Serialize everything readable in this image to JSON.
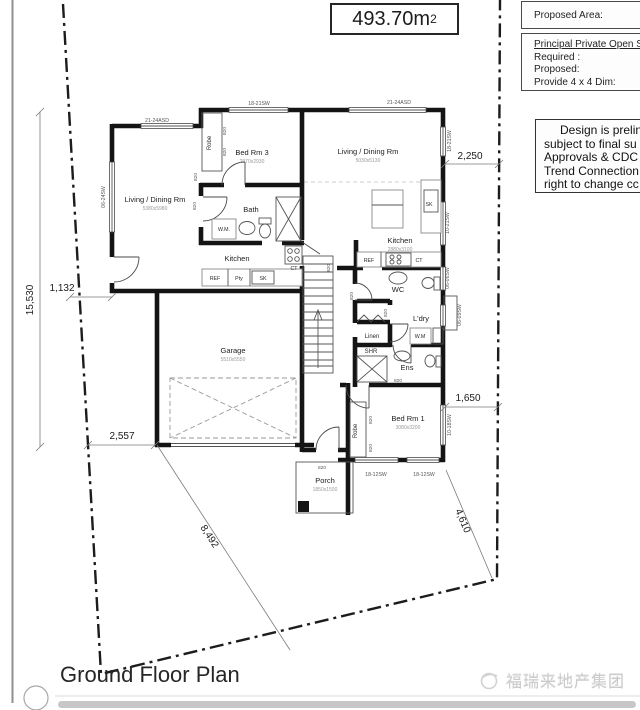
{
  "header": {
    "area": "493.70m",
    "area_sup": "2"
  },
  "side": {
    "proposed_area_label": "Proposed Area:",
    "pos_title": "Principal Private Open Spa",
    "pos_required": "Required :",
    "pos_proposed": "Proposed:",
    "pos_provide": "Provide 4 x 4 Dim:",
    "note_line1": "Design is prelin",
    "note_line2": "subject to final su",
    "note_line3": "Approvals & CDC",
    "note_line4": "Trend Connection",
    "note_line5": "right to change cc"
  },
  "plan": {
    "rooms": {
      "living_left": {
        "name": "Living / Dining Rm",
        "size": "5380x5980"
      },
      "bed3": {
        "name": "Bed Rm 3",
        "size": "2970x2930"
      },
      "bath": {
        "name": "Bath"
      },
      "kitchen_left": {
        "name": "Kitchen"
      },
      "living_right": {
        "name": "Living / Dining Rm",
        "size": "5030x5130"
      },
      "kitchen_right": {
        "name": "Kitchen",
        "size": "2880x3100"
      },
      "wc": {
        "name": "WC"
      },
      "ldry": {
        "name": "L'dry"
      },
      "linen": {
        "name": "Linen"
      },
      "shr": {
        "name": "SHR"
      },
      "ens": {
        "name": "Ens"
      },
      "bed1": {
        "name": "Bed Rm 1",
        "size": "3080x3200"
      },
      "garage": {
        "name": "Garage",
        "size": "5510x5550"
      },
      "porch": {
        "name": "Porch",
        "size": "1850x1500"
      },
      "robe": {
        "name": "Robe"
      }
    },
    "fixtures": {
      "ref": "REF",
      "pty": "Pty",
      "sk": "SK",
      "ct": "CT",
      "wm": "W.M.",
      "wm_short": "W.M"
    },
    "door_label": "820",
    "windows": {
      "w1": "21-24ASD",
      "w2": "18-21SW",
      "w3": "21-24ASD",
      "w4": "06-24SW",
      "w5": "18-21SW",
      "w6": "10-21SW",
      "w7": "06-06SW",
      "w8": "06-09SW",
      "w9": "10-18SW",
      "w10": "18-12SW",
      "w11": "18-12SW"
    },
    "dims": {
      "d15530": "15,530",
      "d1132": "1,132",
      "d2557": "2,557",
      "d8492": "8,492",
      "d4610": "4,610",
      "d2250": "2,250",
      "d1650": "1,650"
    }
  },
  "footer": {
    "title": "Ground Floor Plan",
    "watermark": "福瑞来地产集团"
  }
}
